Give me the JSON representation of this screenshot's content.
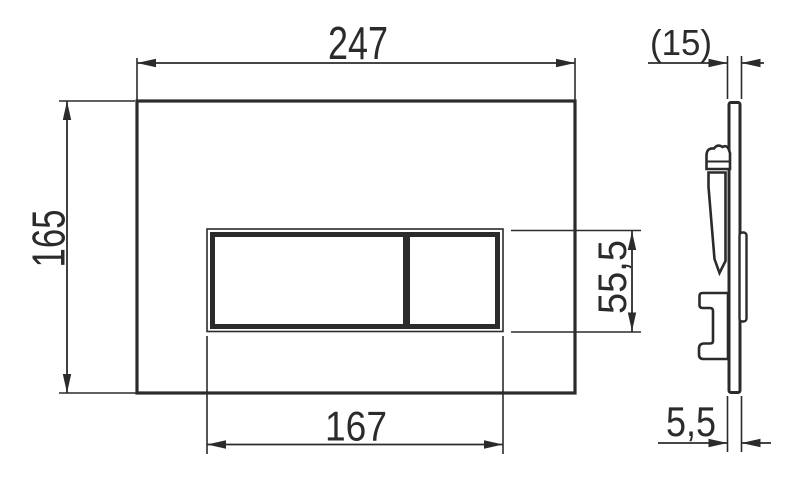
{
  "colors": {
    "line": "#2b2b2b",
    "background": "#ffffff"
  },
  "dimensions": {
    "plate_width": "247",
    "plate_height": "165",
    "button_width": "167",
    "button_height": "55,5",
    "depth_overall": "(15)",
    "plate_thickness": "5,5"
  }
}
